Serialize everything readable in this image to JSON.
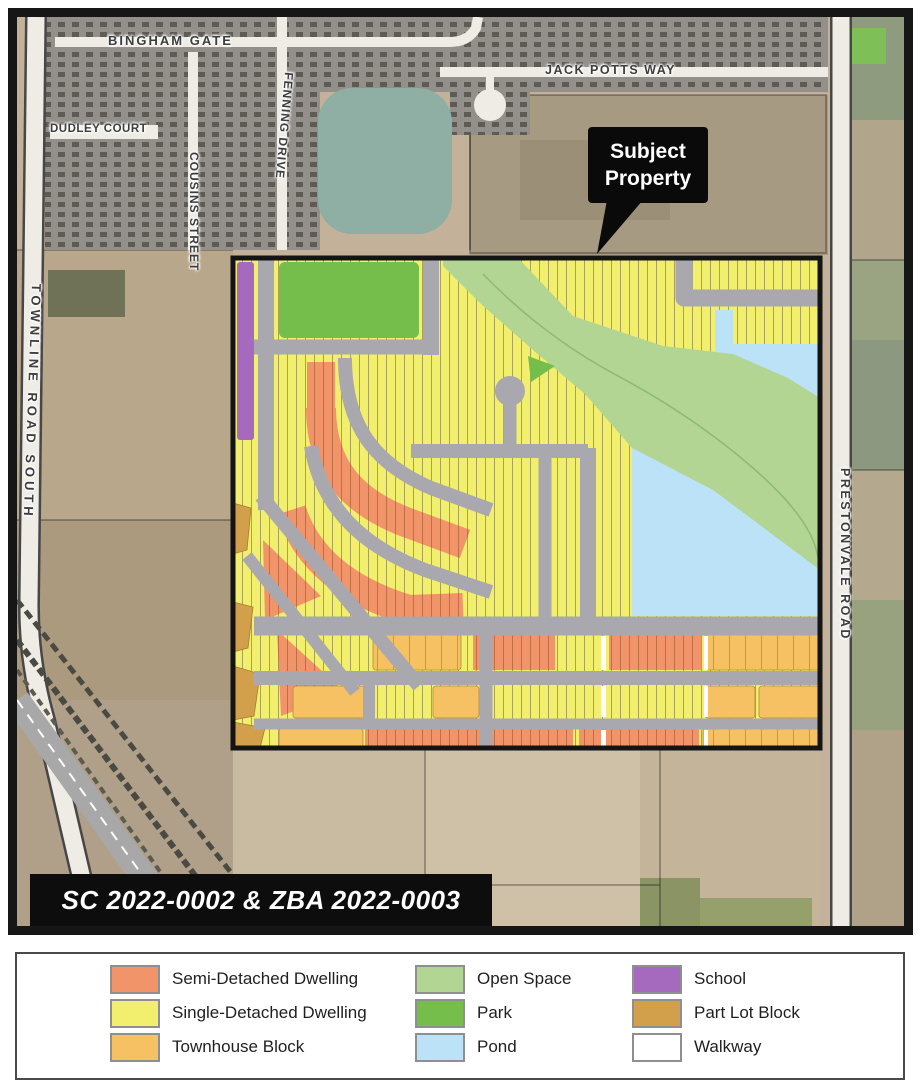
{
  "map": {
    "street_labels": {
      "bingham_gate": "BINGHAM GATE",
      "jack_potts_way": "JACK POTTS WAY",
      "dudley_court": "DUDLEY COURT",
      "cousins_street": "COUSINS STREET",
      "fenning_drive": "FENNING DRIVE",
      "townline_road_south": "TOWNLINE ROAD SOUTH",
      "prestonvale_road": "PRESTONVALE ROAD"
    },
    "callout": {
      "line1": "Subject",
      "line2": "Property"
    },
    "case_label": "SC 2022-0002 & ZBA 2022-0003"
  },
  "legend": {
    "items": [
      {
        "label": "Semi-Detached Dwelling",
        "color": "#F2946A"
      },
      {
        "label": "Single-Detached Dwelling",
        "color": "#F2EE6E"
      },
      {
        "label": "Townhouse Block",
        "color": "#F5C163"
      },
      {
        "label": "Open Space",
        "color": "#B3D593"
      },
      {
        "label": "Park",
        "color": "#76BE4B"
      },
      {
        "label": "Pond",
        "color": "#BCE2F8"
      },
      {
        "label": "School",
        "color": "#A569BE"
      },
      {
        "label": "Part Lot Block",
        "color": "#D2A04A"
      },
      {
        "label": "Walkway",
        "color": "#FFFFFF"
      }
    ]
  },
  "colors": {
    "road": "#A9A8AE",
    "plan_border": "#141414",
    "map_frame": "#161616",
    "aerial_field": "#C3B299",
    "aerial_subdivision": "#93908B",
    "aerial_pond": "#8FAEA4"
  }
}
